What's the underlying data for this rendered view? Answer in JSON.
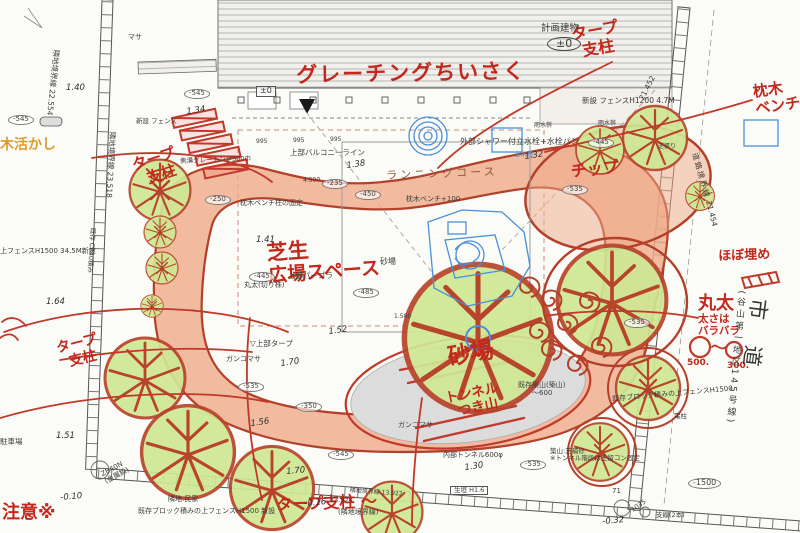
{
  "red_annotations": [
    {
      "t": "グレーチングちいさく"
    },
    {
      "t": "タープ",
      "t2": "支柱"
    },
    {
      "t": "枕木",
      "t2": "ベンチ"
    },
    {
      "t": "タープ",
      "t2": "支柱"
    },
    {
      "t": "ほぼ埋め"
    },
    {
      "t": "丸太",
      "t2": "太さは",
      "t3": "バラバラ"
    },
    {
      "t": "500."
    },
    {
      "t": "300."
    },
    {
      "t": "チップ"
    },
    {
      "t": "芝生",
      "t2": "広場スペース"
    },
    {
      "t": "砂場"
    },
    {
      "t": "トンネル",
      "t2": "つき山"
    },
    {
      "t": "タープ",
      "t2": "支柱"
    },
    {
      "t": "タープ支柱 〜"
    },
    {
      "t": "注意※"
    }
  ],
  "orange_annotations": [
    {
      "t": "木活かし"
    }
  ],
  "printed_labels": [
    {
      "t": "計画建物"
    },
    {
      "t": "±0"
    },
    {
      "t": "新設 フェンスH1200 4.7M"
    },
    {
      "t": "外部シャワー付立水栓+水栓パン"
    },
    {
      "t": "立水栓"
    },
    {
      "t": "上部バルコニーライン"
    },
    {
      "t": "ランニングコース"
    },
    {
      "t": "上部パーゴラ"
    },
    {
      "t": "枕木ベンチ柱の固定"
    },
    {
      "t": "枕木ベンチ+100"
    },
    {
      "t": "丸太(切り株)"
    },
    {
      "t": "砂場"
    },
    {
      "t": "ガンコマサ"
    },
    {
      "t": "ガンコマサ"
    },
    {
      "t": "▽上部タープ"
    },
    {
      "t": "側溝グレーチング300巾"
    },
    {
      "t": "新設 フェンス"
    },
    {
      "t": "マサ"
    },
    {
      "t": "隣地:民家"
    },
    {
      "t": "既存ブロック積みの上フェンスH1500 新設"
    },
    {
      "t": "既存ブロック積みの上フェンスH1500"
    },
    {
      "t": "ZB40N",
      "t2": "(金属鋲)"
    },
    {
      "t": "駐車場"
    },
    {
      "t": "電柱"
    },
    {
      "t": "支線(2本)"
    },
    {
      "t": "生垣  H1.6"
    },
    {
      "t": "既存築山(築山)",
      "t2": "〜600"
    },
    {
      "t": "内部トンネル600φ"
    },
    {
      "t": "築山:芝補修",
      "t2": "※トンネル階段は土留コン固定"
    },
    {
      "t": "市道"
    },
    {
      "t": "(谷山第一地区145号線)"
    },
    {
      "t": "道路境界線"
    },
    {
      "t": "21.452"
    },
    {
      "t": "21.454"
    },
    {
      "t": "隣地境界線 22.554"
    },
    {
      "t": "隣地境界線 23.518"
    },
    {
      "t": "既存 CB40積み"
    },
    {
      "t": "上フェンスH1500 34.5M新設"
    },
    {
      "t": "雨水桝"
    },
    {
      "t": "雨水桝"
    },
    {
      "t": "芝張り"
    },
    {
      "t": "995"
    },
    {
      "t": "995"
    },
    {
      "t": "995"
    },
    {
      "t": "4.500"
    },
    {
      "t": "1.500"
    },
    {
      "t": "1035"
    },
    {
      "t": "71"
    },
    {
      "t": "隣地境界線 13.922"
    },
    {
      "t": "13.924"
    },
    {
      "t": "(隣地境界線)"
    }
  ],
  "spot_levels": [
    {
      "t": "1.40"
    },
    {
      "t": "1.34"
    },
    {
      "t": "1.41"
    },
    {
      "t": "1.38"
    },
    {
      "t": "1.32"
    },
    {
      "t": "1.64"
    },
    {
      "t": "1.51"
    },
    {
      "t": "1.52"
    },
    {
      "t": "1.70"
    },
    {
      "t": "1.56"
    },
    {
      "t": "1.30"
    },
    {
      "t": "1.70"
    },
    {
      "t": "-0.10"
    },
    {
      "t": "-0.16"
    },
    {
      "t": "-0.32"
    },
    {
      "t": "±0"
    }
  ],
  "level_pills": [
    {
      "t": "-235"
    },
    {
      "t": "-450"
    },
    {
      "t": "-445"
    },
    {
      "t": "-485"
    },
    {
      "t": "-445"
    },
    {
      "t": "-535"
    },
    {
      "t": "-535"
    },
    {
      "t": "-535"
    },
    {
      "t": "-350"
    },
    {
      "t": "-545"
    },
    {
      "t": "-545"
    },
    {
      "t": "-545"
    },
    {
      "t": "-535"
    },
    {
      "t": "-250"
    },
    {
      "t": "-1500"
    }
  ],
  "colors": {
    "red_ink": "#c2281d",
    "course_fill": "#f0a988",
    "course_edge": "#b3402a",
    "tree_fill": "#cfe793",
    "equipment_blue": "#4a90d9",
    "sand_gray": "#dcdcdc",
    "orange_note": "#dc9a2f"
  }
}
